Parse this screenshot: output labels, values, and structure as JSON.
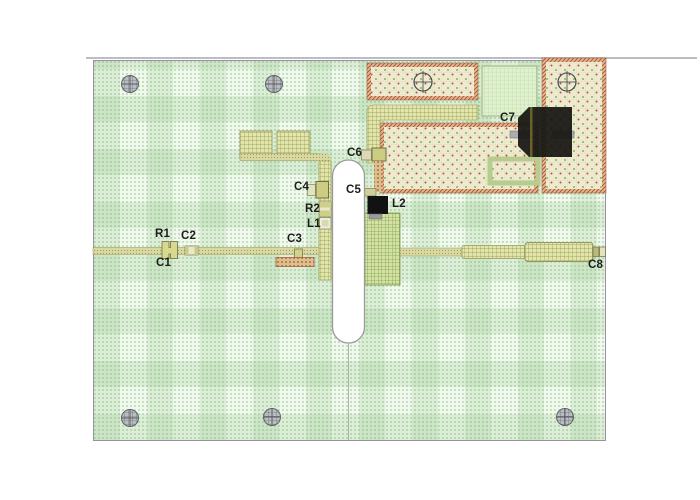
{
  "title": "pcb-layout-view",
  "refdes": {
    "r1": "R1",
    "c1": "C1",
    "c2": "C2",
    "c3": "C3",
    "c4": "C4",
    "r2": "R2",
    "l1": "L1",
    "c5": "C5",
    "c6": "C6",
    "l2": "L2",
    "c7": "C7",
    "c8": "C8"
  },
  "icons": {
    "mounting_hole": "crosshatched-circle",
    "fiducial": "crosshair-circle",
    "routed_slot": "rounded-slot-cutout"
  },
  "colors": {
    "board_fill": "#f1f8ee",
    "board_border": "#9b8fa6",
    "trace_olive": "#d8d8a0",
    "hatch_red": "#bb4f3c",
    "copper_dot_field": "#edead0",
    "dense_fill": "#d6e2a4",
    "component_black": "#171512",
    "lead_gray": "#adadad",
    "hole_gray": "#b9bcc0",
    "label_text": "#1c1c1c"
  }
}
